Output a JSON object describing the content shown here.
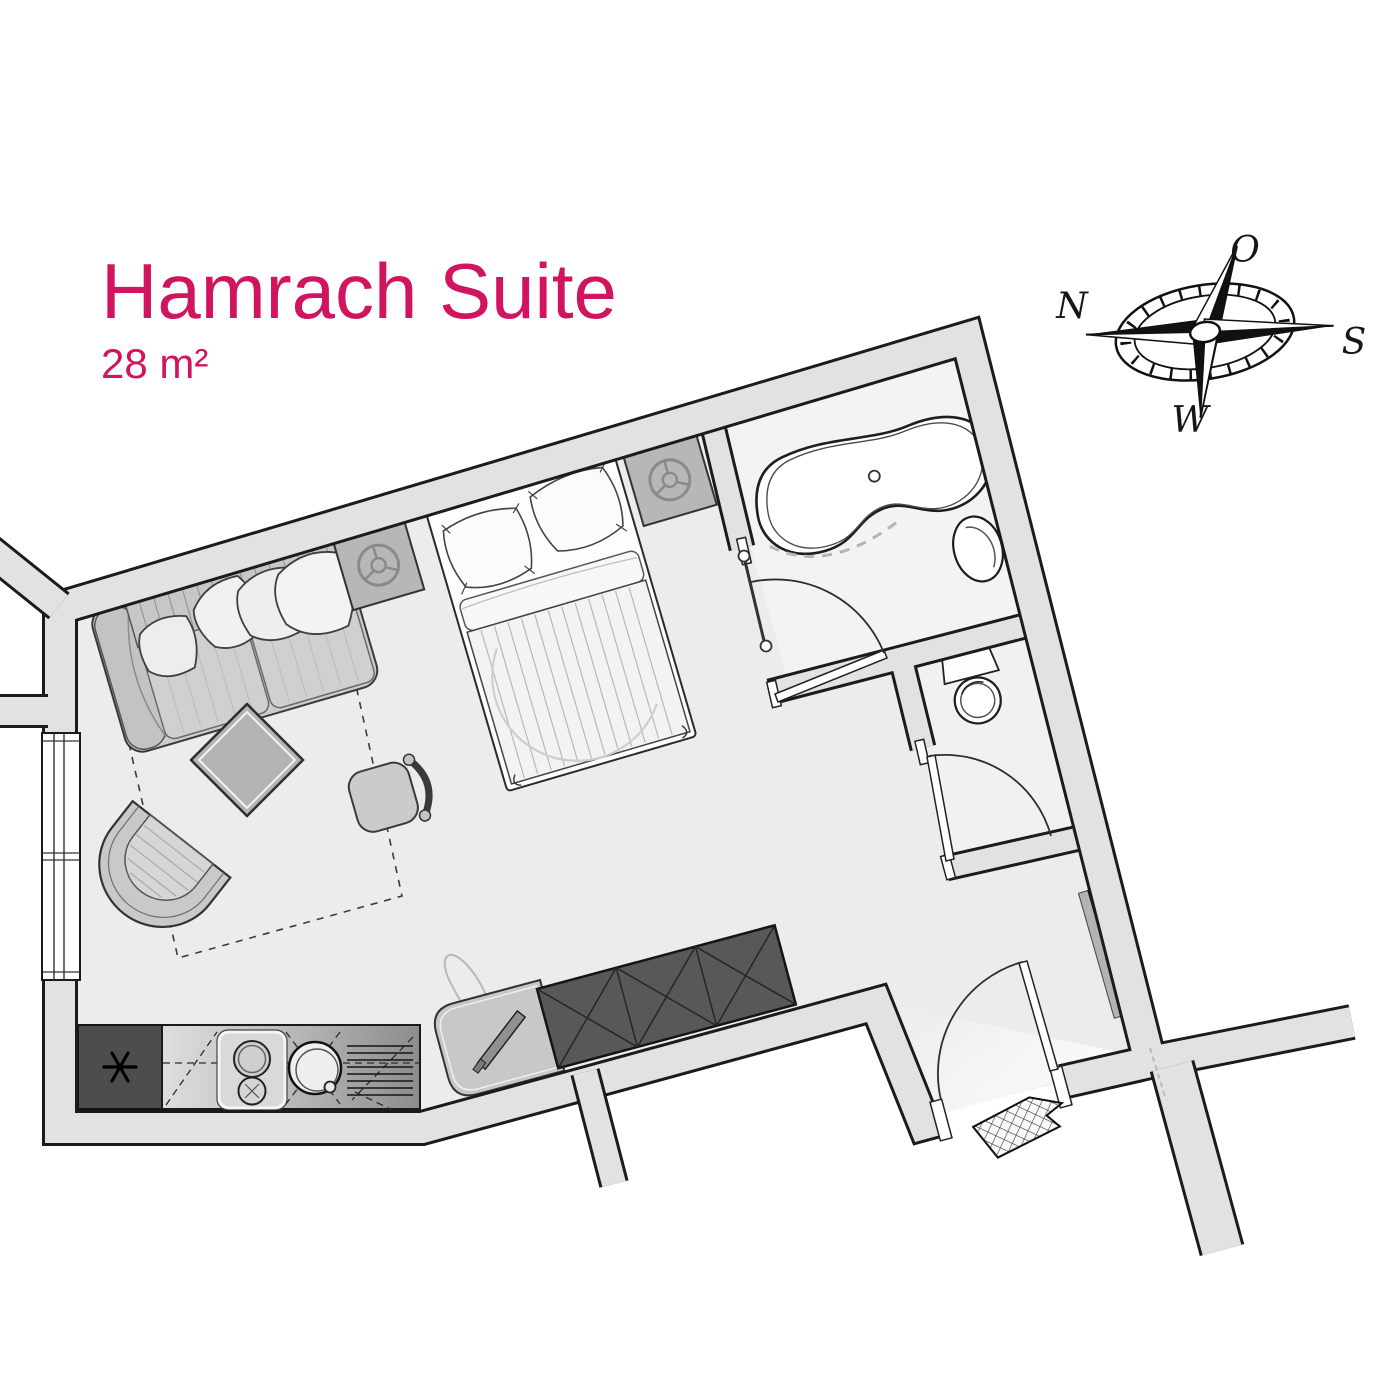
{
  "header": {
    "title": "Hamrach Suite",
    "area": "28 m²"
  },
  "compass": {
    "labels": {
      "north": "N",
      "east": "O",
      "south": "S",
      "west": "W"
    }
  },
  "colors": {
    "accent": "#d0145f",
    "wall_fill": "#e2e2e2",
    "wall_line": "#1b1b1b",
    "floor": "#ececec",
    "bathroom_floor": "#f3f3f3",
    "dark_furniture": "#585858",
    "kitchen_dark": "#4d4d4d"
  },
  "plan": {
    "elements": [
      "sofa",
      "sofa-pillows",
      "sofa-bed-outline",
      "coffee-table",
      "armchair",
      "chair",
      "double-bed",
      "nightstand-left",
      "nightstand-right",
      "wardrobe",
      "desk",
      "kitchenette",
      "fridge",
      "stove",
      "sink",
      "drainer",
      "bathtub",
      "washbasin",
      "toilet",
      "towel-rail",
      "radiator",
      "window",
      "entrance-door",
      "bathroom-door",
      "wc-door",
      "doormat",
      "compass-rose"
    ]
  }
}
